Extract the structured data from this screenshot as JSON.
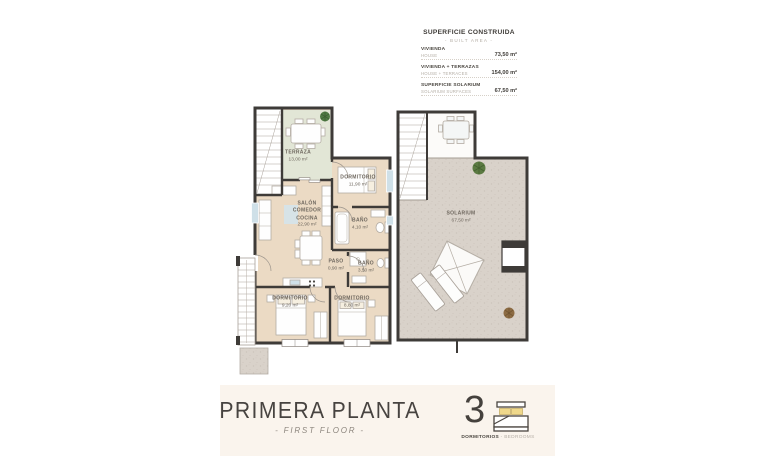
{
  "legend": {
    "title": "SUPERFICIE CONSTRUIDA",
    "subtitle": "- BUILT AREA -",
    "rows": [
      {
        "es": "VIVIENDA",
        "en": "HOUSE",
        "value": "73,50 m²"
      },
      {
        "es": "VIVIENDA + TERRAZAS",
        "en": "HOUSE + TERRACES",
        "value": "154,00 m²"
      },
      {
        "es": "SUPERFICIE SOLARIUM",
        "en": "SOLARIUM SURFACES",
        "value": "67,50 m²"
      }
    ]
  },
  "plan": {
    "rooms": {
      "terraza": {
        "name": "TERRAZA",
        "area": "13,00 m²"
      },
      "salon": {
        "name": "SALÓN\nCOMEDOR\nCOCINA",
        "area": "22,90 m²"
      },
      "dormitorio1": {
        "name": "DORMITORIO",
        "area": "11,90 m²"
      },
      "bano1": {
        "name": "BAÑO",
        "area": "4,10 m²"
      },
      "paso": {
        "name": "PASO",
        "area": "0,90 m²"
      },
      "bano2": {
        "name": "BAÑO",
        "area": "3,50 m²"
      },
      "dormitorio2": {
        "name": "DORMITORIO",
        "area": "9,20 m²"
      },
      "dormitorio3": {
        "name": "DORMITORIO",
        "area": "8,80 m²"
      },
      "solarium": {
        "name": "SOLARIUM",
        "area": "67,50 m²"
      }
    }
  },
  "footer": {
    "title": "PRIMERA PLANTA",
    "subtitle": "- FIRST FLOOR -",
    "bedrooms": {
      "count": "3",
      "es": "DORMITORIOS",
      "sep": " - ",
      "en": "BEDROOMS"
    }
  },
  "colors": {
    "wall": "#3e3b38",
    "floor_beige": "#ebdac4",
    "terrace_green": "#e2e6d6",
    "solarium_gray": "#d9d2ca",
    "pillow_yellow": "#efd88b",
    "footer_band": "#faf4ed",
    "text_dark": "#45413d",
    "text_light": "#b5aea6"
  }
}
